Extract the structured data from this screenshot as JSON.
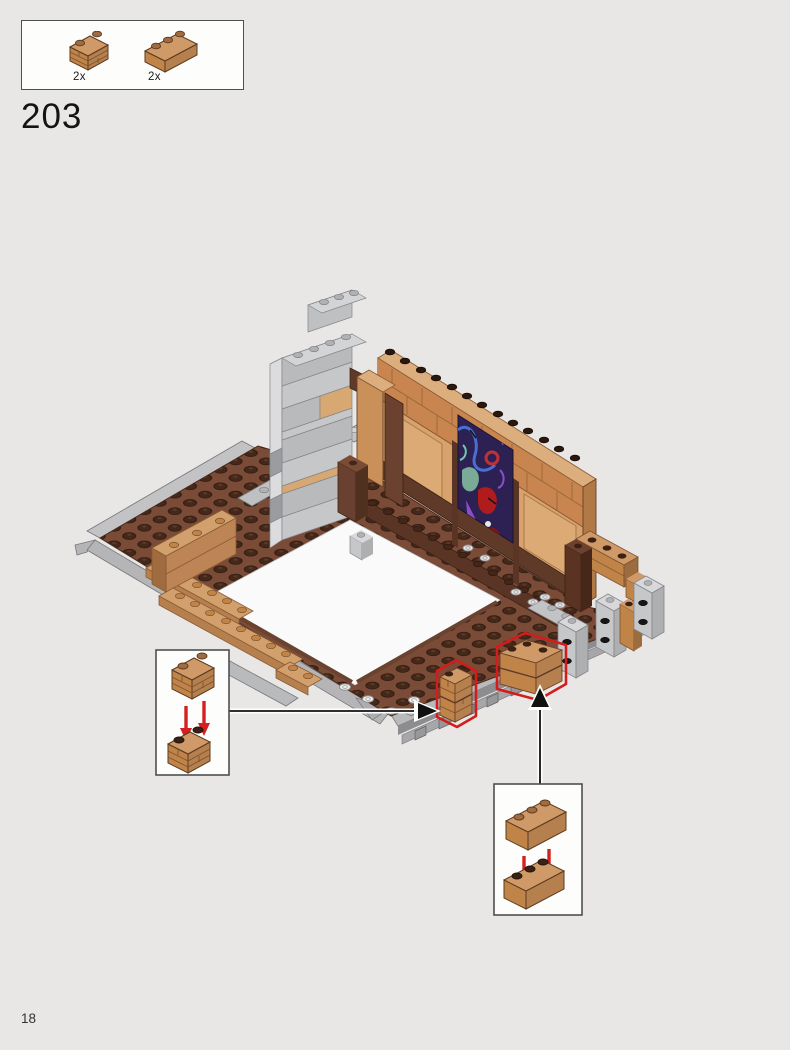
{
  "page": {
    "background_color": "#e8e7e5",
    "page_number": "18"
  },
  "step": {
    "number": "203"
  },
  "parts_panel": {
    "items": [
      {
        "icon": "brick-1x2-masonry-icon",
        "part": "masonry brick 1x2 medium nougat",
        "count": "2x"
      },
      {
        "icon": "brick-1x3-icon",
        "part": "brick 1x3 medium nougat",
        "count": "2x"
      }
    ]
  },
  "callouts": [
    {
      "id": "masonry-stack-callout",
      "icon": "brick-1x2-masonry-stack-icon",
      "content": "two 1x2 masonry bricks stacked",
      "arrow_direction": "right"
    },
    {
      "id": "brick-1x3-stack-callout",
      "icon": "brick-1x3-stack-icon",
      "content": "two 1x3 bricks stacked",
      "arrow_direction": "up"
    }
  ],
  "colors": {
    "highlight_red": "#d41c1c",
    "callout_arrow_red": "#d42020",
    "reddish_brown_floor": "#7a4b37",
    "dark_stud_brown": "#4a2c1e",
    "medium_nougat": "#c08449",
    "nougat_light": "#d7a26c",
    "wall_dark_brown": "#5f3a29",
    "light_bluish_gray": "#c6c7c9",
    "baseplate_gray": "#b9babc",
    "graffiti_background": "#2c2152",
    "graffiti_blue": "#4a6fd4",
    "graffiti_teal": "#7aab97",
    "graffiti_red": "#b01c1c"
  }
}
